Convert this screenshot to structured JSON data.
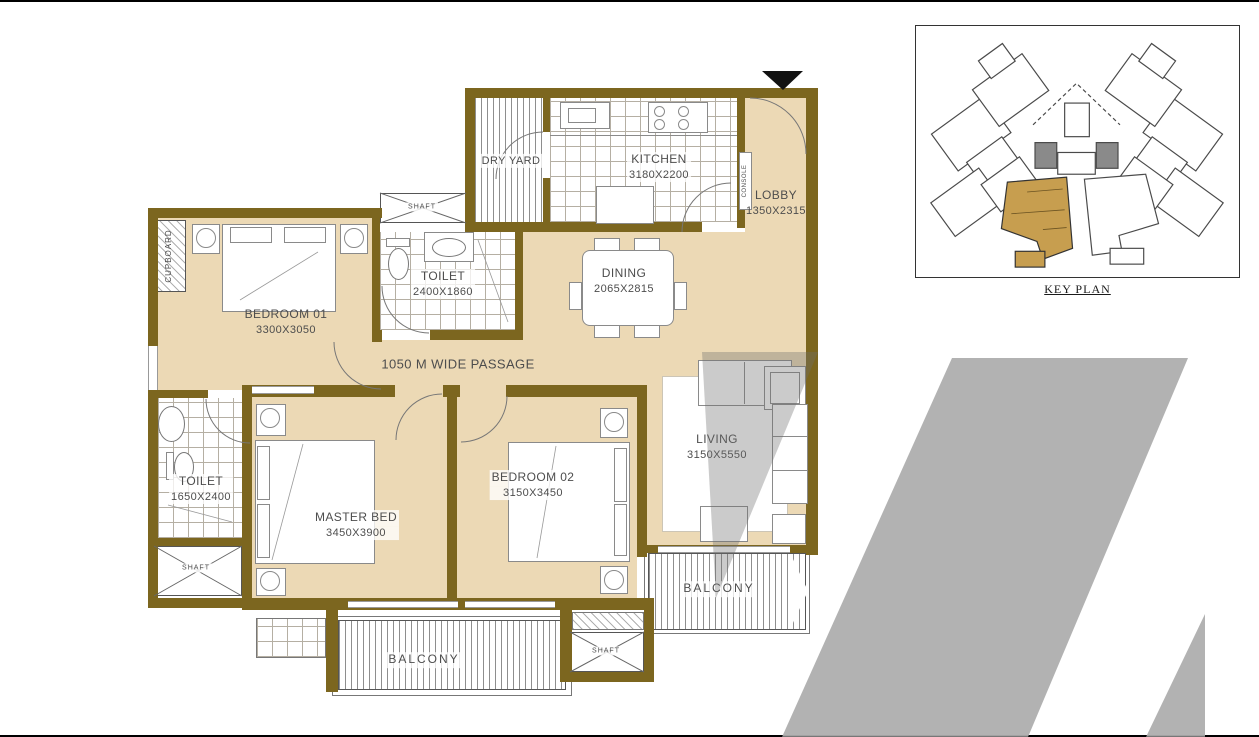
{
  "floor_plan": {
    "rooms": {
      "dry_yard": {
        "label": "DRY YARD"
      },
      "kitchen": {
        "label": "KITCHEN",
        "dims": "3180X2200"
      },
      "lobby": {
        "label": "LOBBY",
        "dims": "1350X2315"
      },
      "dining": {
        "label": "DINING",
        "dims": "2065X2815"
      },
      "toilet_common": {
        "label": "TOILET",
        "dims": "2400X1860"
      },
      "bedroom_01": {
        "label": "BEDROOM 01",
        "dims": "3300X3050"
      },
      "passage": {
        "label": "1050 M WIDE PASSAGE"
      },
      "toilet_master": {
        "label": "TOILET",
        "dims": "1650X2400"
      },
      "master_bed": {
        "label": "MASTER BED",
        "dims": "3450X3900"
      },
      "bedroom_02": {
        "label": "BEDROOM 02",
        "dims": "3150X3450"
      },
      "living": {
        "label": "LIVING",
        "dims": "3150X5550"
      },
      "balcony_master": {
        "label": "BALCONY"
      },
      "balcony_living": {
        "label": "BALCONY"
      },
      "shaft_top": {
        "label": "SHAFT"
      },
      "shaft_left": {
        "label": "SHAFT"
      },
      "shaft_bottom": {
        "label": "SHAFT"
      },
      "cupboard": {
        "label": "CUPBOARD"
      },
      "console": {
        "label": "CONSOLE"
      }
    }
  },
  "key_plan": {
    "caption": "KEY PLAN"
  },
  "colors": {
    "wall": "#7c661f",
    "floor": "#ecd9b5",
    "watermark": "#b2b2b2",
    "text": "#4d4d4d",
    "keyplan_highlight": "#c79e4f"
  }
}
